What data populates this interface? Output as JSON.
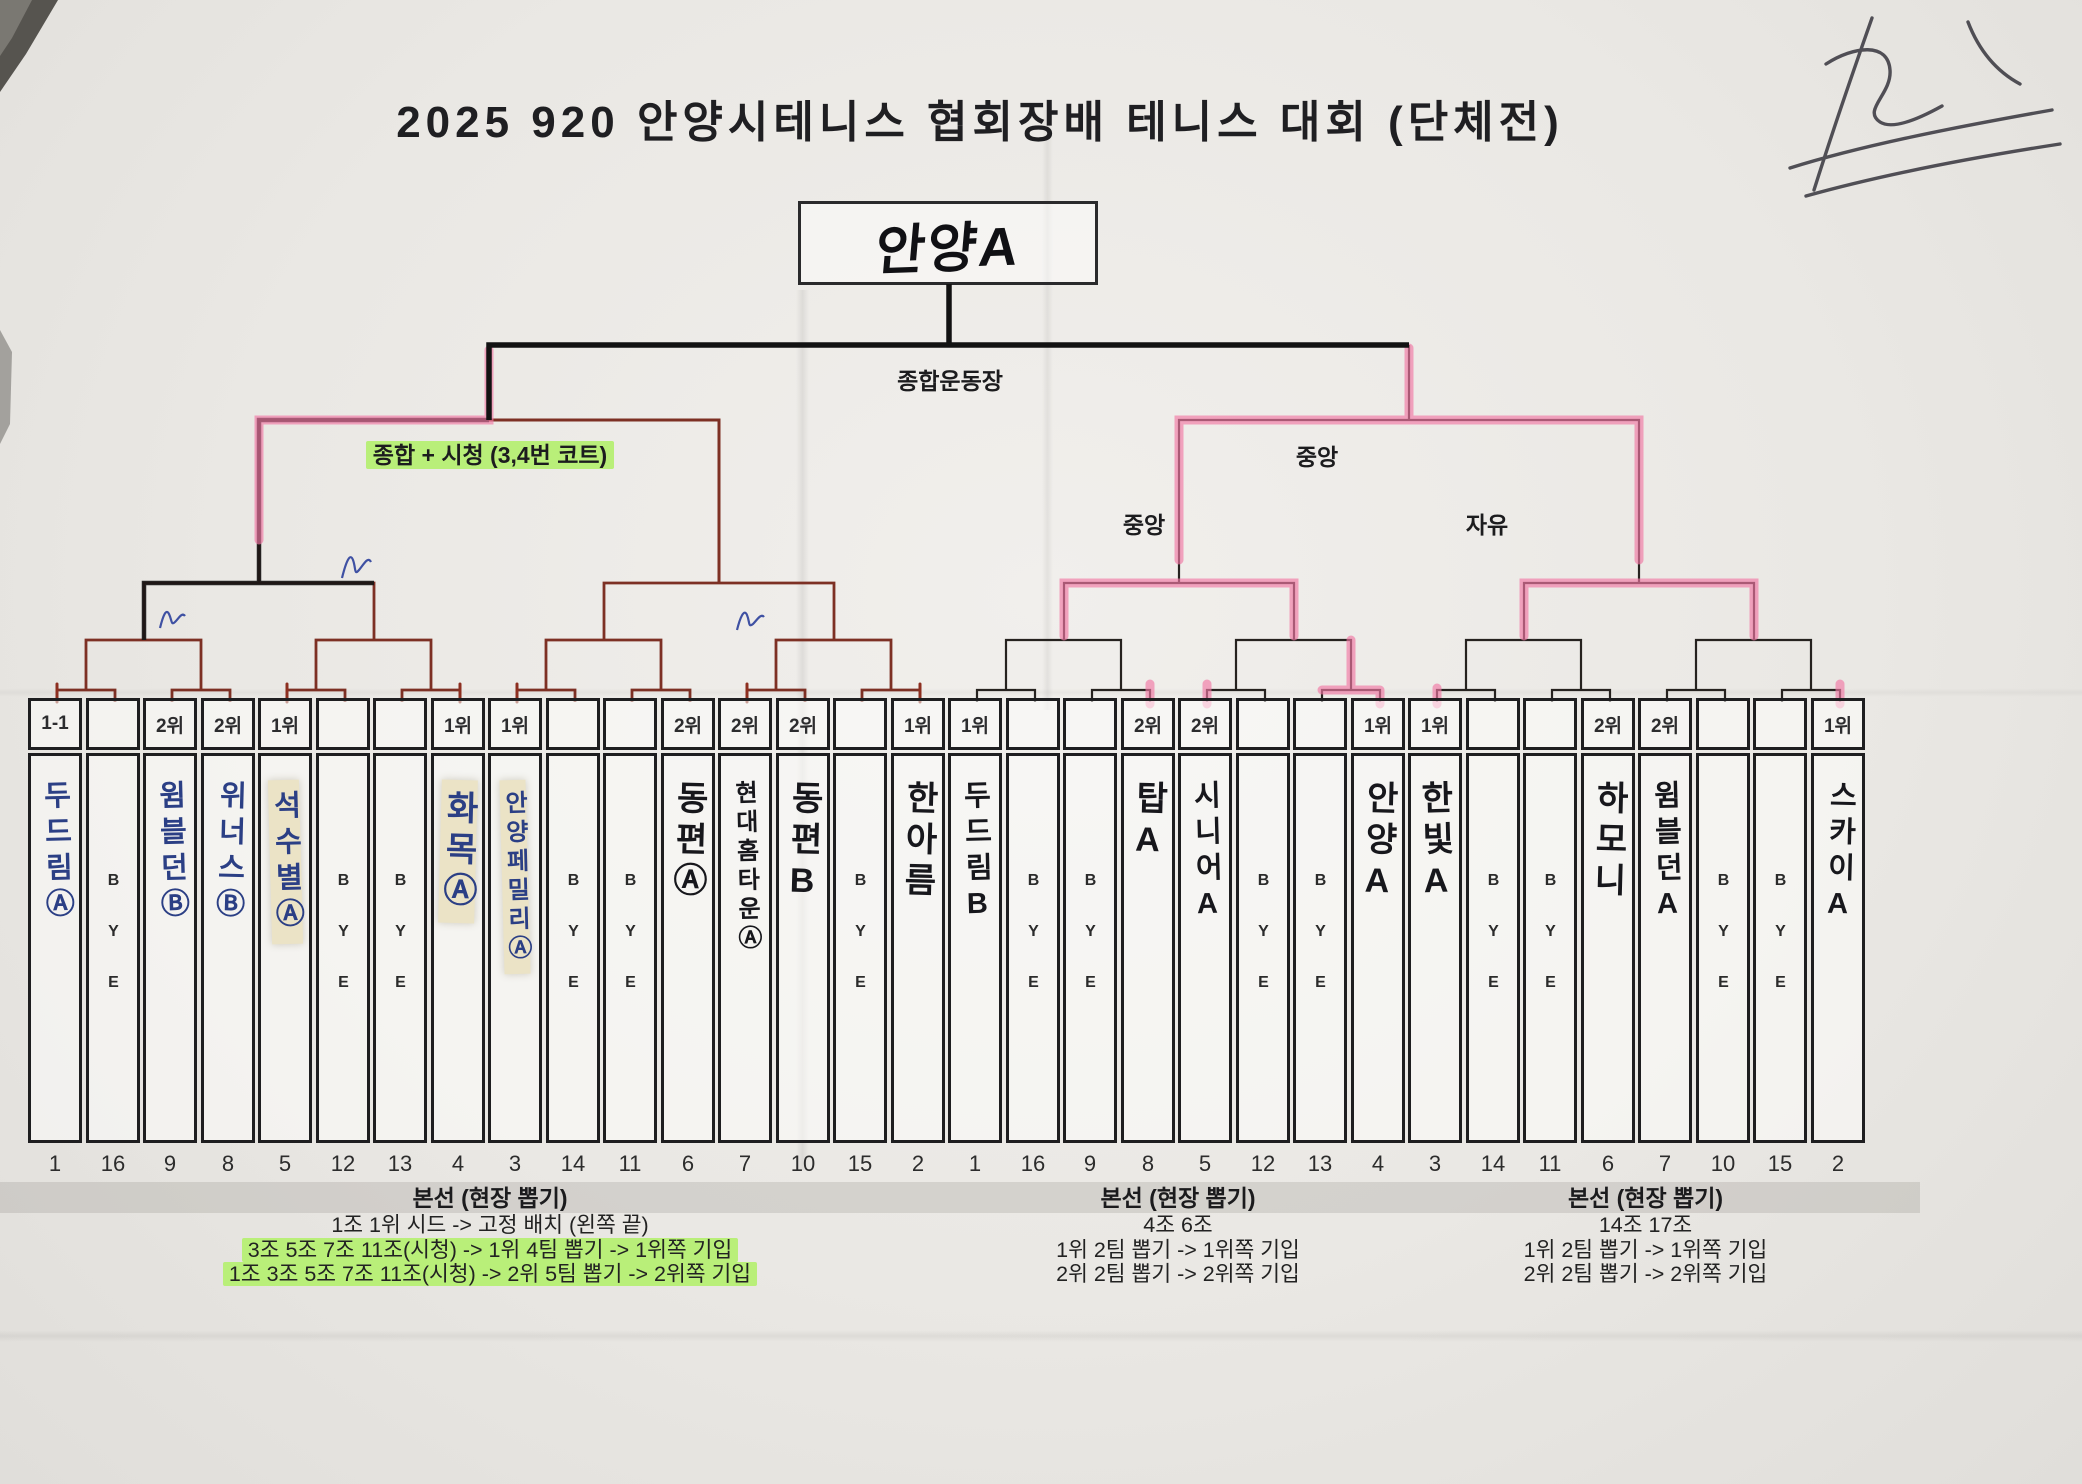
{
  "title": "2025 920 안양시테니스 협회장배 테니스 대회 (단체전)",
  "champion": "안양A",
  "labels": {
    "final_venue": "종합운동장",
    "left_semifinal_venue": "종합 + 시청 (3,4번 코트)",
    "right_semifinal_venue": "중앙",
    "right_quarter1_venue": "중앙",
    "right_quarter2_venue": "자유"
  },
  "slots": [
    {
      "rank": "1-1",
      "team": "두드림Ⓐ",
      "draw": "1",
      "bye": false,
      "ink": "blue",
      "tape": false
    },
    {
      "rank": "",
      "team": "BYE",
      "draw": "16",
      "bye": true
    },
    {
      "rank": "2위",
      "team": "윔블던Ⓑ",
      "draw": "9",
      "bye": false,
      "ink": "blue",
      "tape": false
    },
    {
      "rank": "2위",
      "team": "위너스Ⓑ",
      "draw": "8",
      "bye": false,
      "ink": "blue",
      "tape": false
    },
    {
      "rank": "1위",
      "team": "석수별Ⓐ",
      "draw": "5",
      "bye": false,
      "ink": "blue",
      "tape": true
    },
    {
      "rank": "",
      "team": "BYE",
      "draw": "12",
      "bye": true
    },
    {
      "rank": "",
      "team": "BYE",
      "draw": "13",
      "bye": true
    },
    {
      "rank": "1위",
      "team": "화목Ⓐ",
      "draw": "4",
      "bye": false,
      "ink": "blue",
      "tape": true
    },
    {
      "rank": "1위",
      "team": "안양페밀리Ⓐ",
      "draw": "3",
      "bye": false,
      "ink": "blue",
      "tape": true
    },
    {
      "rank": "",
      "team": "BYE",
      "draw": "14",
      "bye": true
    },
    {
      "rank": "",
      "team": "BYE",
      "draw": "11",
      "bye": true
    },
    {
      "rank": "2위",
      "team": "동편Ⓐ",
      "draw": "6",
      "bye": false,
      "ink": "black",
      "tape": false
    },
    {
      "rank": "2위",
      "team": "현대홈타운Ⓐ",
      "draw": "7",
      "bye": false,
      "ink": "black",
      "tape": false
    },
    {
      "rank": "2위",
      "team": "동편B",
      "draw": "10",
      "bye": false,
      "ink": "black",
      "tape": false
    },
    {
      "rank": "",
      "team": "BYE",
      "draw": "15",
      "bye": true
    },
    {
      "rank": "1위",
      "team": "한아름",
      "draw": "2",
      "bye": false,
      "ink": "black",
      "tape": false
    },
    {
      "rank": "1위",
      "team": "두드림B",
      "draw": "1",
      "bye": false,
      "ink": "black",
      "tape": false
    },
    {
      "rank": "",
      "team": "BYE",
      "draw": "16",
      "bye": true
    },
    {
      "rank": "",
      "team": "BYE",
      "draw": "9",
      "bye": true
    },
    {
      "rank": "2위",
      "team": "탑A",
      "draw": "8",
      "bye": false,
      "ink": "black",
      "tape": false
    },
    {
      "rank": "2위",
      "team": "시니어A",
      "draw": "5",
      "bye": false,
      "ink": "black",
      "tape": false
    },
    {
      "rank": "",
      "team": "BYE",
      "draw": "12",
      "bye": true
    },
    {
      "rank": "",
      "team": "BYE",
      "draw": "13",
      "bye": true
    },
    {
      "rank": "1위",
      "team": "안양A",
      "draw": "4",
      "bye": false,
      "ink": "black",
      "tape": false
    },
    {
      "rank": "1위",
      "team": "한빛A",
      "draw": "3",
      "bye": false,
      "ink": "black",
      "tape": false
    },
    {
      "rank": "",
      "team": "BYE",
      "draw": "14",
      "bye": true
    },
    {
      "rank": "",
      "team": "BYE",
      "draw": "11",
      "bye": true
    },
    {
      "rank": "2위",
      "team": "하모니",
      "draw": "6",
      "bye": false,
      "ink": "black",
      "tape": false
    },
    {
      "rank": "2위",
      "team": "윔블던A",
      "draw": "7",
      "bye": false,
      "ink": "black",
      "tape": false
    },
    {
      "rank": "",
      "team": "BYE",
      "draw": "10",
      "bye": true
    },
    {
      "rank": "",
      "team": "BYE",
      "draw": "15",
      "bye": true
    },
    {
      "rank": "1위",
      "team": "스카이A",
      "draw": "2",
      "bye": false,
      "ink": "black",
      "tape": false
    }
  ],
  "notes": {
    "left": {
      "header": "본선 (현장 뽑기)",
      "lines": [
        {
          "text": "1조 1위 시드 -> 고정 배치 (왼쪽 끝)",
          "highlight": false
        },
        {
          "text": "3조 5조 7조 11조(시청) -> 1위 4팀 뽑기 -> 1위쪽 기입",
          "highlight": true
        },
        {
          "text": "1조 3조 5조 7조 11조(시청) -> 2위 5팀 뽑기 -> 2위쪽 기입",
          "highlight": true
        }
      ]
    },
    "middle": {
      "header": "본선 (현장 뽑기)",
      "lines": [
        {
          "text": "4조 6조",
          "highlight": false
        },
        {
          "text": "1위 2팀 뽑기 -> 1위쪽 기입",
          "highlight": false
        },
        {
          "text": "2위 2팀 뽑기 -> 2위쪽 기입",
          "highlight": false
        }
      ]
    },
    "right": {
      "header": "본선 (현장 뽑기)",
      "lines": [
        {
          "text": "14조 17조",
          "highlight": false
        },
        {
          "text": "1위 2팀 뽑기 -> 1위쪽 기입",
          "highlight": false
        },
        {
          "text": "2위 2팀 뽑기 -> 2위쪽 기입",
          "highlight": false
        }
      ]
    }
  },
  "colors": {
    "left_bracket_ink": "#7d3024",
    "right_bracket_ink": "#26221f",
    "winner_highlight_pink": "#f178a5",
    "note_highlight_green": "#b9ef79",
    "pen_blue": "#2b3f85",
    "marker_black": "#17171c"
  }
}
